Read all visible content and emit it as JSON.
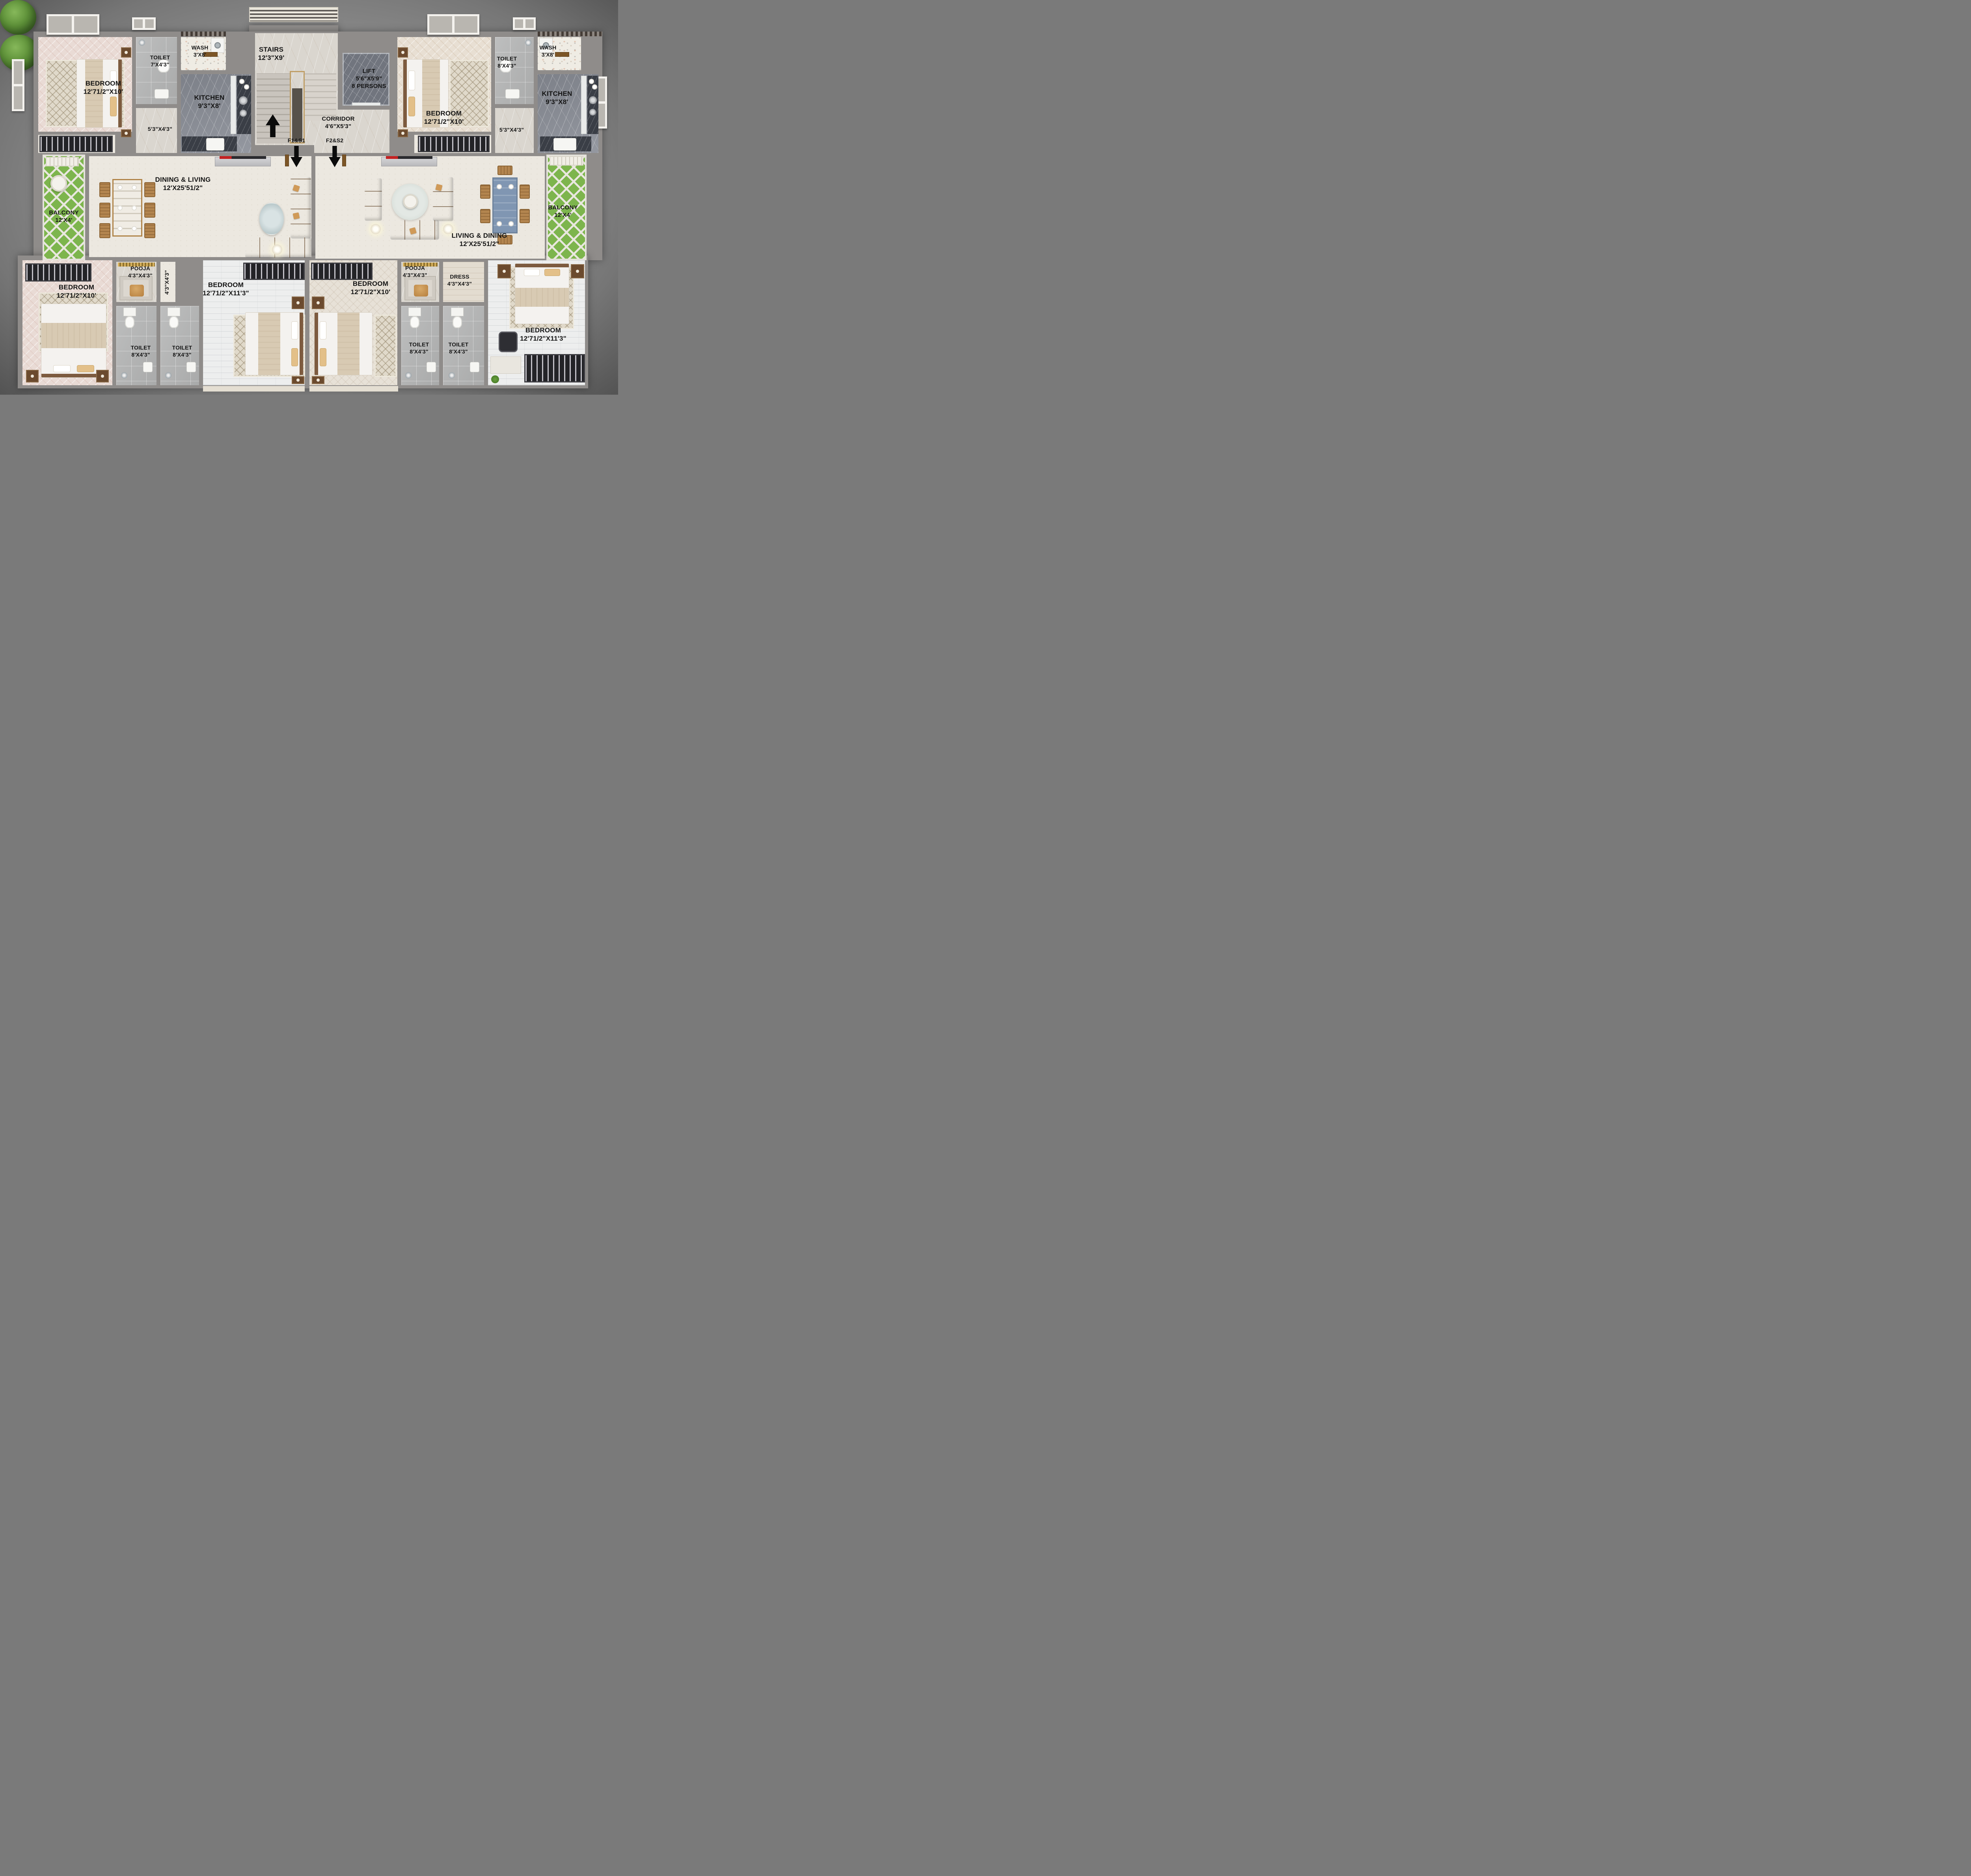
{
  "plan": {
    "type": "Residential apartment floor plan - two mirrored units",
    "unit_labels": [
      "F1&S1",
      "F2&S2"
    ]
  },
  "rooms": {
    "bedroom_tl": {
      "name": "BEDROOM",
      "dims": "12'71/2\"X10'"
    },
    "toilet_tl": {
      "name": "TOILET",
      "dims": "7'X4'3\""
    },
    "wash_l": {
      "name": "WASH",
      "dims": "3'X8'"
    },
    "kitchen_l": {
      "name": "KITCHEN",
      "dims": "9'3\"X8'"
    },
    "pass_tl": {
      "dims": "5'3\"X4'3\""
    },
    "stairs": {
      "name": "STAIRS",
      "dims": "12'3\"X9'"
    },
    "lift": {
      "name": "LIFT",
      "dims": "5'6\"X5'9\"",
      "extra": "8 PERSONS"
    },
    "corridor": {
      "name": "CORRIDOR",
      "dims": "4'6\"X5'3\""
    },
    "dining_living_l": {
      "name": "DINING & LIVING",
      "dims": "12'X25'51/2\""
    },
    "balcony_l": {
      "name": "BALCONY",
      "dims": "12'X4'"
    },
    "bedroom_tr": {
      "name": "BEDROOM",
      "dims": "12'71/2\"X10'"
    },
    "toilet_tr": {
      "name": "TOILET",
      "dims": "8'X4'3\""
    },
    "wash_r": {
      "name": "WASH",
      "dims": "3'X8'"
    },
    "kitchen_r": {
      "name": "KITCHEN",
      "dims": "9'3\"X8'"
    },
    "pass_tr": {
      "dims": "5'3\"X4'3\""
    },
    "living_dining_r": {
      "name": "LIVING & DINING",
      "dims": "12'X25'51/2\""
    },
    "balcony_r": {
      "name": "BALCONY",
      "dims": "12'X4'"
    },
    "bedroom_bl": {
      "name": "BEDROOM",
      "dims": "12'71/2\"X10'"
    },
    "pooja_l": {
      "name": "POOJA",
      "dims": "4'3\"X4'3\""
    },
    "pass_bl": {
      "dims": "4'3\"X4'3\""
    },
    "toilet_bl1": {
      "name": "TOILET",
      "dims": "8'X4'3\""
    },
    "toilet_bl2": {
      "name": "TOILET",
      "dims": "8'X4'3\""
    },
    "bedroom_bc_left": {
      "name": "BEDROOM",
      "dims": "12'71/2\"X11'3\""
    },
    "bedroom_bc_right": {
      "name": "BEDROOM",
      "dims": "12'71/2\"X10'"
    },
    "pooja_r": {
      "name": "POOJA",
      "dims": "4'3\"X4'3\""
    },
    "dress": {
      "name": "DRESS",
      "dims": "4'3\"X4'3\""
    },
    "toilet_br1": {
      "name": "TOILET",
      "dims": "8'X4'3\""
    },
    "toilet_br2": {
      "name": "TOILET",
      "dims": "8'X4'3\""
    },
    "bedroom_br": {
      "name": "BEDROOM",
      "dims": "12'71/2\"X11'3\""
    }
  },
  "markers": {
    "f1": {
      "label": "F1&S1"
    },
    "f2": {
      "label": "F2&S2"
    }
  },
  "colors": {
    "background": "#8c8c8c",
    "wall": "#8f8c8a",
    "floor_cream": "#ece8e0",
    "floor_tile_gray": "#b6b7b7",
    "kitchen_marble": "#8b8f98",
    "balcony_green": "#7db54d",
    "sofa_orange": "#c0793a",
    "dining_table_blue": "#8096b2",
    "wood": "#a97a45",
    "label_text": "#141414"
  }
}
